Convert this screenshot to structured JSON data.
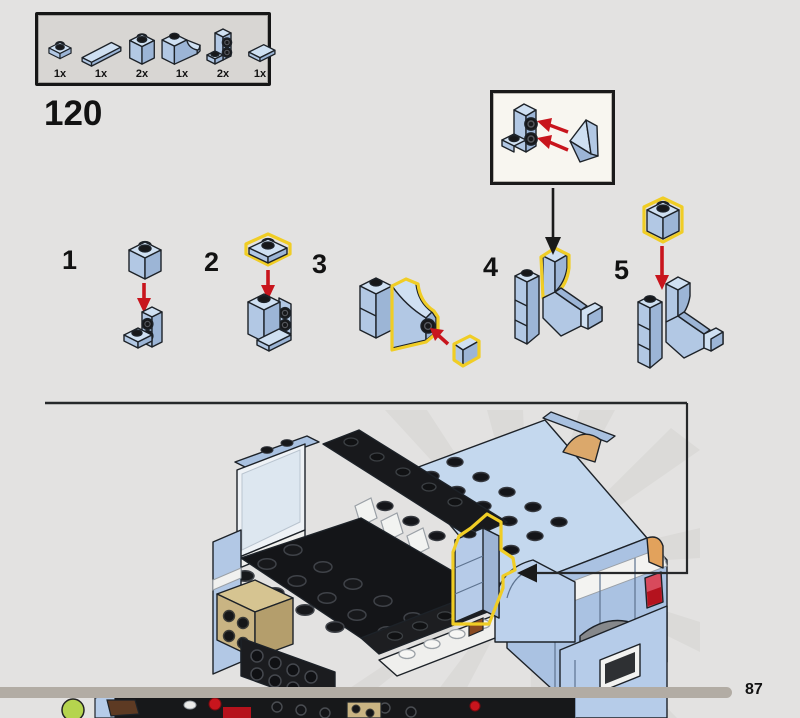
{
  "page": {
    "step_number": "120",
    "page_number": "87"
  },
  "parts_box": {
    "items": [
      {
        "part": "plate-1x1",
        "qty": "1x"
      },
      {
        "part": "slope-1x2-wedge",
        "qty": "1x"
      },
      {
        "part": "brick-1x1",
        "qty": "2x"
      },
      {
        "part": "brick-1x1-curved-cutout",
        "qty": "1x"
      },
      {
        "part": "bracket-1x1-two-side-studs",
        "qty": "2x"
      },
      {
        "part": "tile-1x2",
        "qty": "1x"
      }
    ]
  },
  "steps": [
    {
      "label": "1"
    },
    {
      "label": "2"
    },
    {
      "label": "3"
    },
    {
      "label": "4"
    },
    {
      "label": "5"
    }
  ],
  "colors": {
    "background": "#e3e2e1",
    "brick_blue_light": "#cfe0f2",
    "brick_blue_mid": "#b2c8e4",
    "brick_blue_dark": "#9cb5d6",
    "highlight_yellow": "#f0cd25",
    "arrow_red": "#c8151d",
    "outline_black": "#1d2228",
    "callout_background": "#f8f6f0",
    "parts_box_background": "#d8d6d3",
    "page_bar_gray": "#b2aca4",
    "tan": "#c9b483",
    "lime_green": "#b5d44e"
  }
}
